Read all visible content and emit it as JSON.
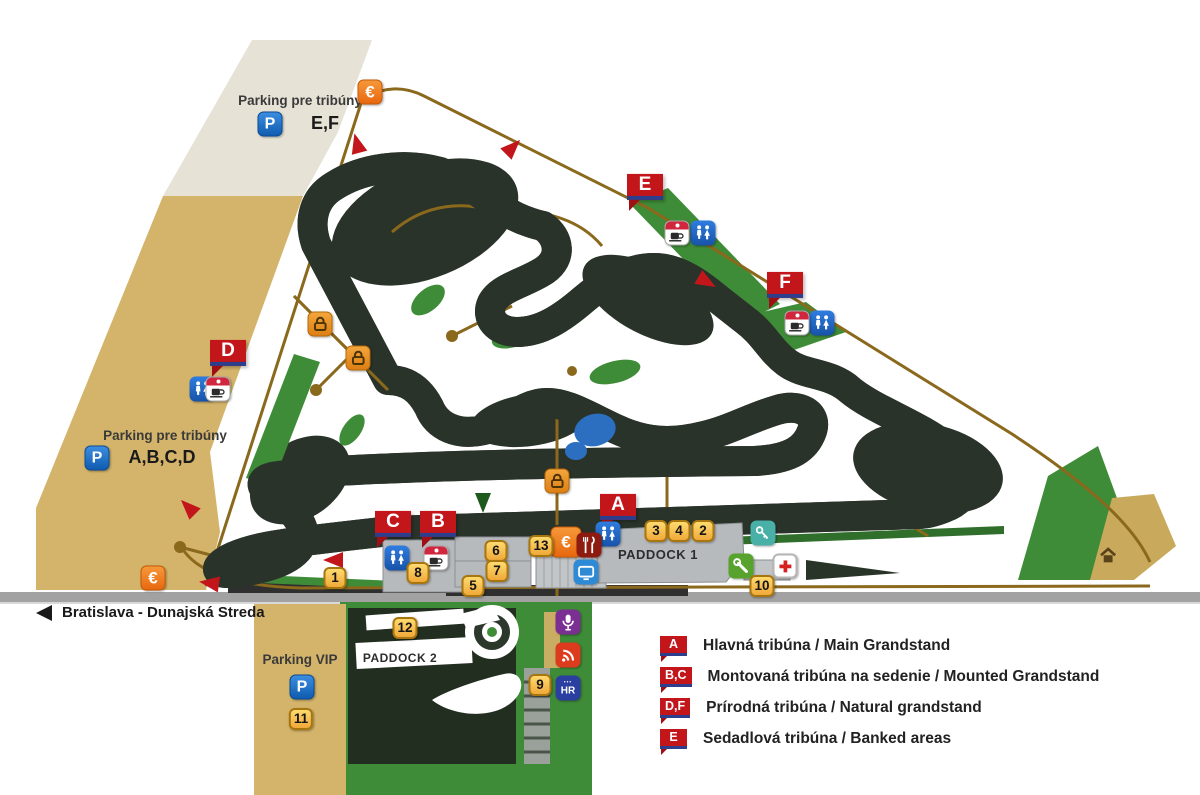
{
  "labels": {
    "parking_ef_title": "Parking pre tribúny",
    "parking_ef_zones": "E,F",
    "parking_abcd_title": "Parking pre tribúny",
    "parking_abcd_zones": "A,B,C,D",
    "parking_vip_title": "Parking VIP",
    "road_sign": "Bratislava - Dunajská Streda",
    "paddock1": "PADDOCK 1",
    "paddock2": "PADDOCK 2",
    "parking_letter": "P",
    "euro_symbol": "€"
  },
  "legend": {
    "items": [
      {
        "marker": "A",
        "text": "Hlavná tribúna / Main Grandstand"
      },
      {
        "marker": "B,C",
        "text": "Montovaná tribúna na sedenie / Mounted Grandstand"
      },
      {
        "marker": "D,F",
        "text": "Prírodná tribúna / Natural grandstand"
      },
      {
        "marker": "E",
        "text": "Sedadlová tribúna / Banked areas"
      }
    ]
  },
  "map": {
    "grandstands": [
      {
        "letter": "A",
        "x": 618,
        "y": 509
      },
      {
        "letter": "B",
        "x": 438,
        "y": 526
      },
      {
        "letter": "C",
        "x": 393,
        "y": 526
      },
      {
        "letter": "D",
        "x": 228,
        "y": 355
      },
      {
        "letter": "E",
        "x": 645,
        "y": 189
      },
      {
        "letter": "F",
        "x": 785,
        "y": 287
      }
    ],
    "numbers": [
      {
        "n": "1",
        "x": 335,
        "y": 578
      },
      {
        "n": "2",
        "x": 703,
        "y": 531
      },
      {
        "n": "3",
        "x": 656,
        "y": 531
      },
      {
        "n": "4",
        "x": 679,
        "y": 531
      },
      {
        "n": "5",
        "x": 473,
        "y": 586
      },
      {
        "n": "6",
        "x": 496,
        "y": 551
      },
      {
        "n": "7",
        "x": 497,
        "y": 571
      },
      {
        "n": "8",
        "x": 418,
        "y": 573
      },
      {
        "n": "9",
        "x": 540,
        "y": 685
      },
      {
        "n": "10",
        "x": 762,
        "y": 586
      },
      {
        "n": "11",
        "x": 301,
        "y": 719
      },
      {
        "n": "12",
        "x": 405,
        "y": 628
      },
      {
        "n": "13",
        "x": 541,
        "y": 546
      }
    ],
    "icons": [
      {
        "type": "euro",
        "x": 370,
        "y": 92
      },
      {
        "type": "euro",
        "x": 153,
        "y": 578
      },
      {
        "type": "euro",
        "x": 566,
        "y": 542,
        "s": 31
      },
      {
        "type": "lock",
        "x": 320,
        "y": 324
      },
      {
        "type": "lock",
        "x": 358,
        "y": 358
      },
      {
        "type": "lock",
        "x": 557,
        "y": 481
      },
      {
        "type": "wc",
        "x": 703,
        "y": 233
      },
      {
        "type": "wc",
        "x": 822,
        "y": 323
      },
      {
        "type": "wc",
        "x": 202,
        "y": 389
      },
      {
        "type": "wc",
        "x": 397,
        "y": 558
      },
      {
        "type": "wc",
        "x": 608,
        "y": 534
      },
      {
        "type": "coffee",
        "x": 677,
        "y": 233
      },
      {
        "type": "coffee",
        "x": 797,
        "y": 323
      },
      {
        "type": "coffee",
        "x": 218,
        "y": 389
      },
      {
        "type": "coffee",
        "x": 436,
        "y": 558
      },
      {
        "type": "restaurant",
        "x": 589,
        "y": 545
      },
      {
        "type": "screen",
        "x": 586,
        "y": 572
      },
      {
        "type": "key",
        "x": 763,
        "y": 533
      },
      {
        "type": "wrench",
        "x": 741,
        "y": 566
      },
      {
        "type": "medical",
        "x": 785,
        "y": 566
      },
      {
        "type": "mic",
        "x": 568,
        "y": 622
      },
      {
        "type": "signal",
        "x": 568,
        "y": 655
      },
      {
        "type": "hr",
        "x": 568,
        "y": 688,
        "label": "HR"
      },
      {
        "type": "parking",
        "x": 270,
        "y": 124
      },
      {
        "type": "parking",
        "x": 97,
        "y": 458
      },
      {
        "type": "parking",
        "x": 302,
        "y": 687
      },
      {
        "type": "hut",
        "x": 1108,
        "y": 556
      }
    ],
    "arrows": [
      {
        "x": 357,
        "y": 143,
        "rot": -105
      },
      {
        "x": 513,
        "y": 147,
        "rot": -45
      },
      {
        "x": 707,
        "y": 282,
        "rot": 30
      },
      {
        "x": 188,
        "y": 507,
        "rot": -135
      },
      {
        "x": 333,
        "y": 560,
        "rot": 180
      },
      {
        "x": 209,
        "y": 583,
        "rot": 188
      },
      {
        "x": 483,
        "y": 503,
        "rot": 90,
        "color": "green"
      }
    ]
  },
  "colors": {
    "track_yellow": "#f6d500",
    "terrain_dark": "#2a332a",
    "grass_green": "#3f8c38",
    "parking_tan": "#d4b46a",
    "parking_gray": "#e6e2d6",
    "road_brown": "#8a681c",
    "marker_red": "#c2161b",
    "marker_navy": "#2c3e8c",
    "water_blue": "#2c6fc0"
  }
}
